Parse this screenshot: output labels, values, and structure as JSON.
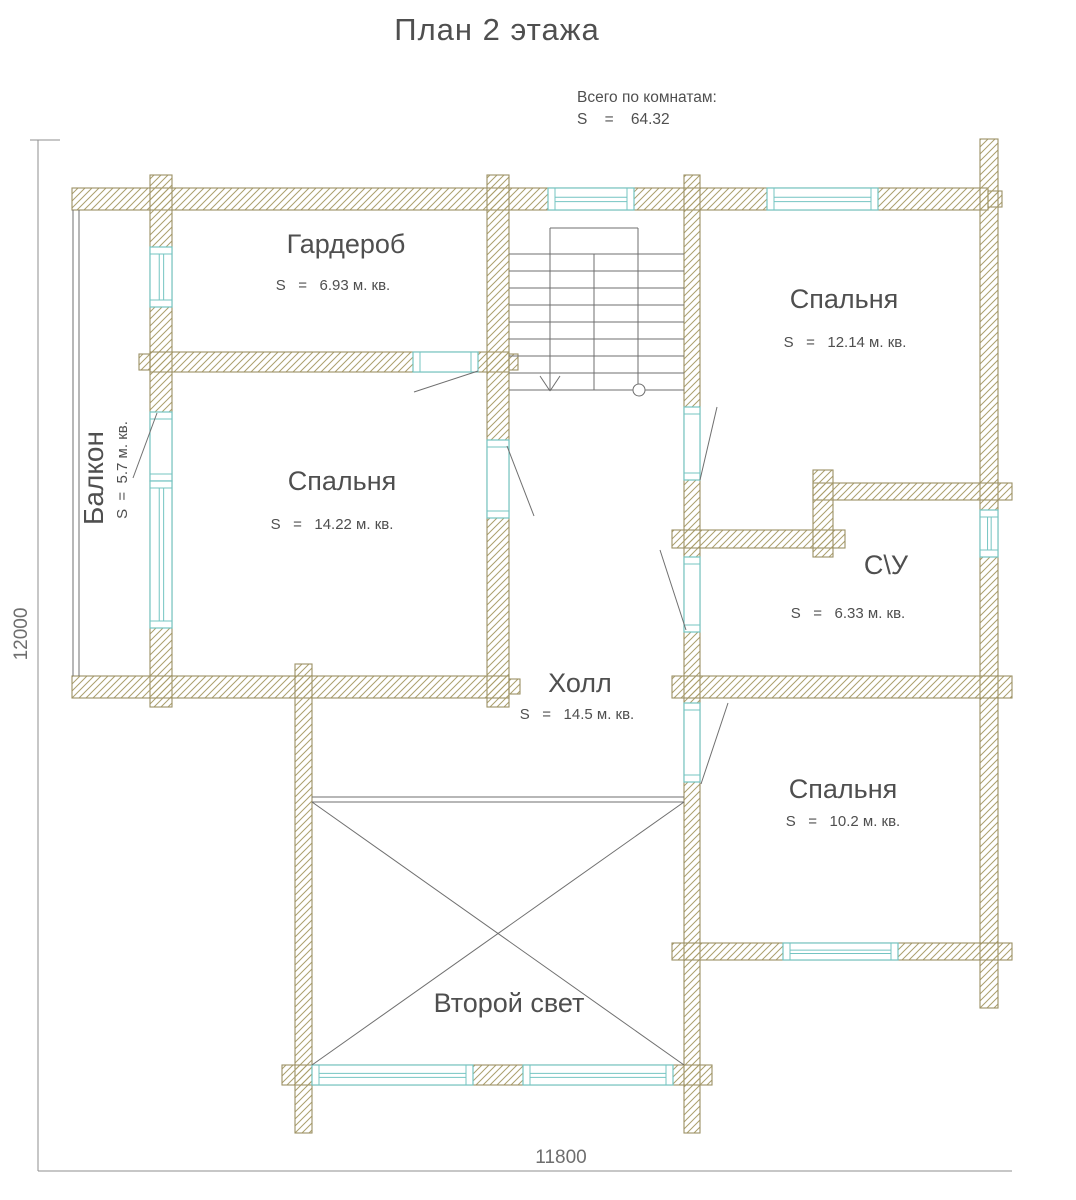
{
  "title": "План 2 этажа",
  "summary": {
    "label": "Всего по комнатам:",
    "value": "S    =    64.32"
  },
  "dimensions": {
    "left": "12000",
    "bottom": "11800"
  },
  "rooms": [
    {
      "id": "garderob",
      "name": "Гардероб",
      "area": "S   =   6.93 м. кв."
    },
    {
      "id": "bedroom-top-right",
      "name": "Спальня",
      "area": "S   =   12.14 м. кв."
    },
    {
      "id": "bedroom-left",
      "name": "Спальня",
      "area": "S   =   14.22 м. кв."
    },
    {
      "id": "bathroom",
      "name": "С\\У",
      "area": "S   =   6.33 м. кв."
    },
    {
      "id": "hall",
      "name": "Холл",
      "area": "S   =   14.5 м. кв."
    },
    {
      "id": "bedroom-bottom-right",
      "name": "Спальня",
      "area": "S   =   10.2 м. кв."
    },
    {
      "id": "second-light",
      "name": "Второй свет",
      "area": ""
    },
    {
      "id": "balcony",
      "name": "Балкон",
      "area": "S  =  5.7 м. кв."
    }
  ],
  "colors": {
    "background": "#ffffff",
    "wall_outline": "#9c9164",
    "wall_hatch": "#ab9f6d",
    "frame": "#74c4c2",
    "text": "#4f4f4f",
    "thin_line": "#6f6f6f",
    "dim_line": "#8f8f8f",
    "dim_text": "#6e6e6e"
  },
  "geometry": {
    "walls": [
      {
        "name": "wall-north",
        "x": 72,
        "y": 188,
        "w": 916,
        "h": 22
      },
      {
        "name": "wall-north-east-nub",
        "x": 988,
        "y": 191,
        "w": 14,
        "h": 16
      },
      {
        "name": "wall-balcony-east",
        "x": 150,
        "y": 175,
        "w": 22,
        "h": 532
      },
      {
        "name": "wall-garderob-south",
        "x": 150,
        "y": 352,
        "w": 359,
        "h": 20
      },
      {
        "name": "wall-garderob-south-nub-w",
        "x": 139,
        "y": 354,
        "w": 11,
        "h": 16
      },
      {
        "name": "wall-garderob-south-nub-e",
        "x": 509,
        "y": 354,
        "w": 9,
        "h": 16
      },
      {
        "name": "wall-hall-west",
        "x": 487,
        "y": 175,
        "w": 22,
        "h": 532
      },
      {
        "name": "wall-hall-east",
        "x": 684,
        "y": 175,
        "w": 16,
        "h": 958
      },
      {
        "name": "wall-east",
        "x": 980,
        "y": 139,
        "w": 18,
        "h": 869
      },
      {
        "name": "wall-mid-south-west",
        "x": 72,
        "y": 676,
        "w": 437,
        "h": 22
      },
      {
        "name": "wall-mid-south-nub",
        "x": 509,
        "y": 679,
        "w": 11,
        "h": 15
      },
      {
        "name": "wall-mid-south-east",
        "x": 672,
        "y": 676,
        "w": 340,
        "h": 22
      },
      {
        "name": "wall-bathroom-north",
        "x": 813,
        "y": 483,
        "w": 199,
        "h": 17
      },
      {
        "name": "wall-bathroom-west",
        "x": 672,
        "y": 530,
        "w": 173,
        "h": 18
      },
      {
        "name": "wall-bathroom-jog",
        "x": 813,
        "y": 470,
        "w": 20,
        "h": 87
      },
      {
        "name": "wall-bedroom-br-south",
        "x": 672,
        "y": 943,
        "w": 340,
        "h": 17
      },
      {
        "name": "wall-secondlight-west",
        "x": 295,
        "y": 664,
        "w": 17,
        "h": 469
      },
      {
        "name": "wall-secondlight-south",
        "x": 282,
        "y": 1065,
        "w": 430,
        "h": 20
      }
    ],
    "openings": [
      {
        "name": "window-stairs-north",
        "x": 548,
        "y": 188,
        "w": 86,
        "h": 22,
        "orient": "h",
        "kind": "window"
      },
      {
        "name": "window-bedroom-tr-north",
        "x": 767,
        "y": 188,
        "w": 111,
        "h": 22,
        "orient": "h",
        "kind": "window"
      },
      {
        "name": "window-garderob-west",
        "x": 150,
        "y": 247,
        "w": 22,
        "h": 60,
        "orient": "v",
        "kind": "window"
      },
      {
        "name": "door-balcony",
        "x": 150,
        "y": 412,
        "w": 22,
        "h": 69,
        "orient": "v",
        "kind": "door"
      },
      {
        "name": "window-bedroom-left-west",
        "x": 150,
        "y": 481,
        "w": 22,
        "h": 147,
        "orient": "v",
        "kind": "window"
      },
      {
        "name": "door-garderob",
        "x": 413,
        "y": 352,
        "w": 65,
        "h": 20,
        "orient": "h",
        "kind": "door"
      },
      {
        "name": "door-bedroom-left",
        "x": 487,
        "y": 440,
        "w": 22,
        "h": 78,
        "orient": "v",
        "kind": "door"
      },
      {
        "name": "door-bedroom-tr",
        "x": 684,
        "y": 407,
        "w": 16,
        "h": 73,
        "orient": "v",
        "kind": "door"
      },
      {
        "name": "door-bathroom",
        "x": 684,
        "y": 557,
        "w": 16,
        "h": 75,
        "orient": "v",
        "kind": "door"
      },
      {
        "name": "door-bedroom-br",
        "x": 684,
        "y": 703,
        "w": 16,
        "h": 79,
        "orient": "v",
        "kind": "door"
      },
      {
        "name": "window-bathroom-east",
        "x": 980,
        "y": 510,
        "w": 18,
        "h": 47,
        "orient": "v",
        "kind": "window"
      },
      {
        "name": "window-bedroom-br-south",
        "x": 783,
        "y": 943,
        "w": 115,
        "h": 17,
        "orient": "h",
        "kind": "window"
      },
      {
        "name": "window-secondlight-south-1",
        "x": 312,
        "y": 1065,
        "w": 161,
        "h": 20,
        "orient": "h",
        "kind": "window"
      },
      {
        "name": "window-secondlight-south-2",
        "x": 523,
        "y": 1065,
        "w": 150,
        "h": 20,
        "orient": "h",
        "kind": "window"
      }
    ],
    "balcony_rail": [
      [
        73,
        210,
        73,
        676
      ],
      [
        79,
        210,
        79,
        676
      ]
    ],
    "secondlight_rail": [
      [
        312,
        797,
        684,
        797
      ],
      [
        312,
        802,
        684,
        802
      ]
    ],
    "secondlight_cross": [
      [
        312,
        802,
        684,
        1065
      ],
      [
        684,
        802,
        312,
        1065
      ]
    ],
    "door_swings": [
      [
        414,
        392,
        478,
        371
      ],
      [
        507,
        446,
        534,
        516
      ],
      [
        717,
        407,
        700,
        480
      ],
      [
        660,
        550,
        686,
        630
      ],
      [
        728,
        703,
        701,
        784
      ]
    ],
    "leaders": [
      [
        133,
        478,
        157,
        413
      ]
    ],
    "stairs": {
      "lines": [
        [
          509,
          254,
          684,
          254
        ],
        [
          509,
          271,
          684,
          271
        ],
        [
          509,
          288,
          684,
          288
        ],
        [
          509,
          305,
          684,
          305
        ],
        [
          509,
          322,
          684,
          322
        ],
        [
          509,
          339,
          684,
          339
        ],
        [
          509,
          356,
          684,
          356
        ],
        [
          509,
          373,
          684,
          373
        ],
        [
          509,
          390,
          684,
          390
        ],
        [
          550,
          228,
          550,
          391
        ],
        [
          638,
          228,
          638,
          384
        ],
        [
          550,
          228,
          638,
          228
        ],
        [
          594,
          254,
          594,
          390
        ],
        [
          540,
          376,
          550,
          391
        ],
        [
          560,
          376,
          550,
          391
        ]
      ],
      "circle": {
        "cx": 639,
        "cy": 390,
        "r": 6
      }
    },
    "dimension_lines": [
      [
        38,
        140,
        38,
        1171
      ],
      [
        38,
        1171,
        1012,
        1171
      ],
      [
        30,
        140,
        60,
        140
      ]
    ]
  }
}
